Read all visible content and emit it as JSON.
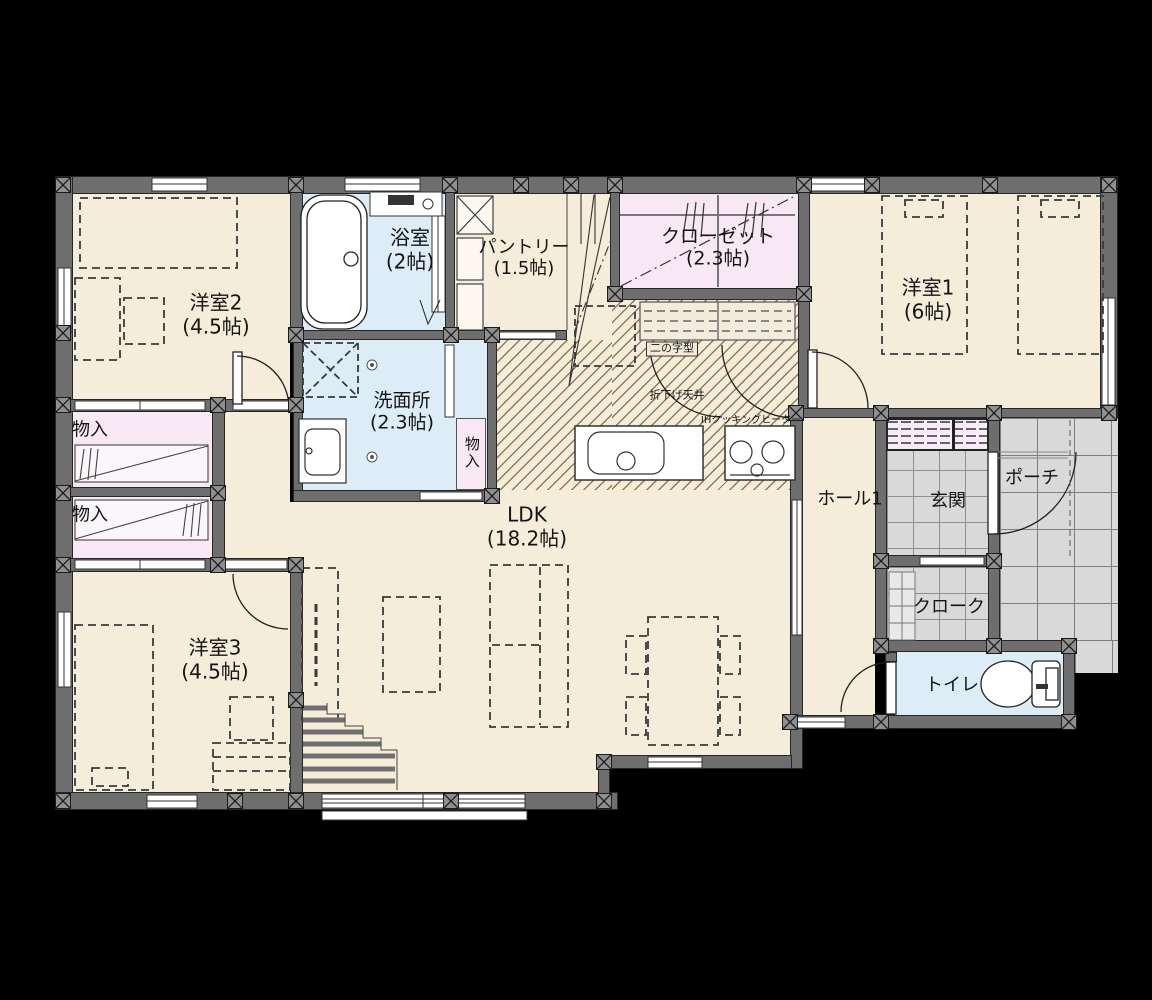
{
  "plan": {
    "rooms": {
      "yoshitsu2": {
        "label": "洋室2",
        "size": "(4.5帖)"
      },
      "bath": {
        "label": "浴室",
        "size": "(2帖)"
      },
      "pantry": {
        "label": "パントリー",
        "size": "(1.5帖)"
      },
      "closet": {
        "label": "クローゼット",
        "size": "(2.3帖)"
      },
      "yoshitsu1": {
        "label": "洋室1",
        "size": "(6帖)"
      },
      "monoire_upper": {
        "label": "物入"
      },
      "monoire_lower": {
        "label": "物入"
      },
      "senmenjo": {
        "label": "洗面所",
        "size": "(2.3帖)"
      },
      "monoire_senmenjo": {
        "label": "物入"
      },
      "ldk": {
        "label": "LDK",
        "size": "(18.2帖)"
      },
      "hall1": {
        "label": "ホール1"
      },
      "genkan": {
        "label": "玄関"
      },
      "porch": {
        "label": "ポーチ"
      },
      "cloak": {
        "label": "クローク"
      },
      "toilet": {
        "label": "トイレ"
      },
      "yoshitsu3": {
        "label": "洋室3",
        "size": "(4.5帖)"
      }
    },
    "kitchen": {
      "layout_note": "二の字型",
      "ceiling_note": "折下げ天井",
      "cooktop_note": "IHクッキングヒーター"
    },
    "colors": {
      "background": "#000000",
      "wall": "#6e6e6e",
      "room_cream": "#f5ecd9",
      "room_pink": "#f8e8f3",
      "room_blue": "#ddedf7",
      "tile_gray": "#d9d9d9"
    }
  }
}
